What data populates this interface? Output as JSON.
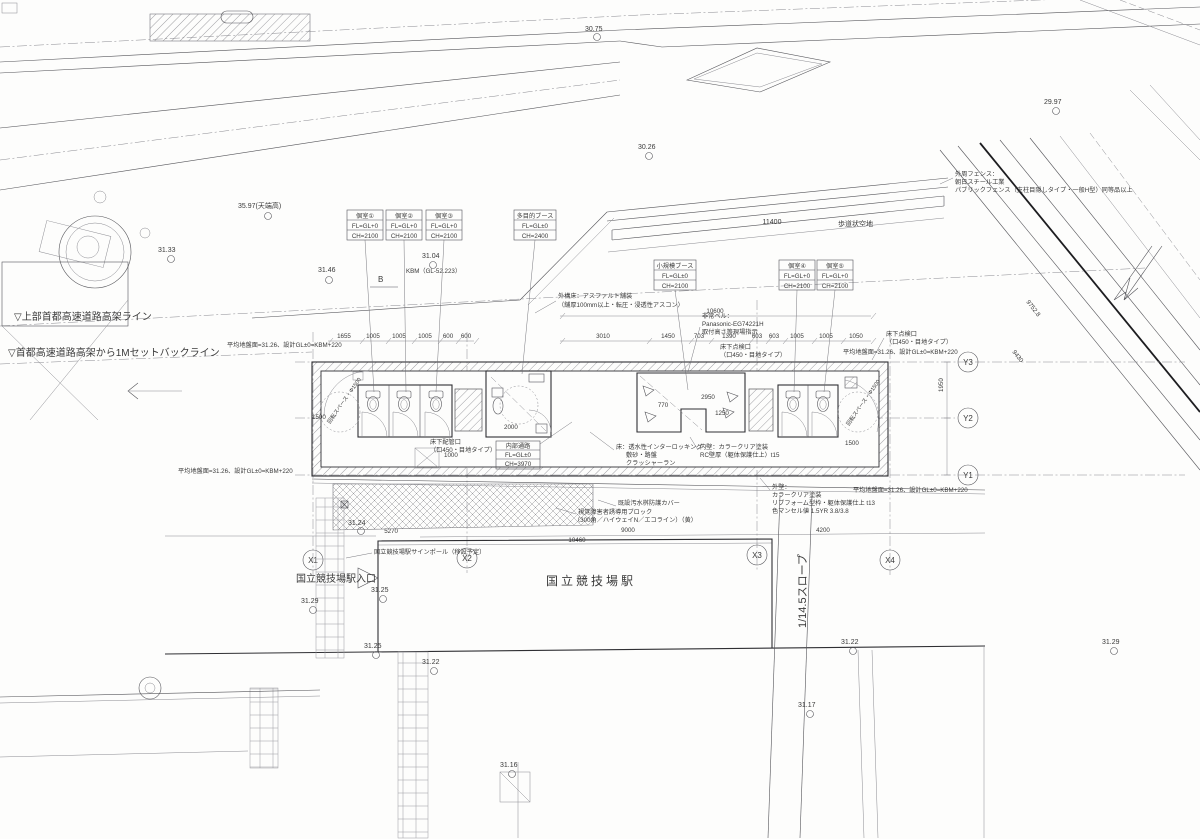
{
  "callouts": [
    {
      "title": "個室①",
      "fl": "FL=GL+0",
      "ch": "CH=2100"
    },
    {
      "title": "個室②",
      "fl": "FL=GL+0",
      "ch": "CH=2100"
    },
    {
      "title": "個室③",
      "fl": "FL=GL+0",
      "ch": "CH=2100"
    },
    {
      "title": "多目的ブース",
      "fl": "FL=GL±0",
      "ch": "CH=2400"
    },
    {
      "title": "小規模ブース",
      "fl": "FL=GL±0",
      "ch": "CH=2100"
    },
    {
      "title": "個室④",
      "fl": "FL=GL+0",
      "ch": "CH=2100"
    },
    {
      "title": "個室⑤",
      "fl": "FL=GL+0",
      "ch": "CH=2100"
    },
    {
      "title": "内部通路",
      "fl": "FL=GL±0",
      "ch": "CH=3970"
    }
  ],
  "grid": {
    "x": [
      "X1",
      "X2",
      "X3",
      "X4"
    ],
    "y": [
      "Y1",
      "Y2",
      "Y3"
    ]
  },
  "section_mark": "B",
  "places": {
    "station": "国立競技場駅",
    "entrance": "国立競技場駅入口",
    "slope": "1/14.5スロープ",
    "sign_pole": "国立競技場駅サインポール（移設予定）",
    "walkway": "歩道状空地"
  },
  "notes": {
    "setback_upper": "▽上部首都高速道路高架ライン",
    "setback_lower": "▽首都高速道路高架から1Mセットバックライン",
    "avg_ground": "平均地盤面=31.26、設計GL±0=KBM+220",
    "kbm": "KBM（GL-52.223）",
    "top_height": "35.97(天端高)",
    "pavement1": "外構床：アスファルト舗装",
    "pavement2": "（舗厚100mm以上・転圧・浸透性アスコン）",
    "bell1": "非常ベル：",
    "bell2": "Panasonic-EG74221H",
    "bell3": "取付高さ等現場指示",
    "hatch1": "床下点検口",
    "hatch2": "（口450・目地タイプ）",
    "pipe1": "床下配管口",
    "fence1": "外周フェンス：",
    "fence2": "朝日スチール工業",
    "fence3": "パブリックフェンス（支柱目隠しタイプ・一般H型）同等品以上",
    "floor1": "床：透水性インターロッキング",
    "floor2": "敷砂・路盤",
    "floor3": "クラッシャーラン",
    "wallin1": "内壁：カラークリア塗装",
    "wallin2": "RC壁厚（躯体保護仕上）t15",
    "wallout1": "外壁：",
    "wallout2": "カラークリア塗装",
    "wallout3": "リブフォーム型枠・躯体保護仕上 t13",
    "wallout4": "色マンセル値 1.5YR 3.8/3.8",
    "cover": "既設汚水桝防護カバー",
    "tactile1": "視覚障害者誘導用ブロック",
    "tactile2": "（300角／ハイウェイN／エコライン）（黄）",
    "rotate_space": "回転スペース・Φ1500"
  },
  "spots": {
    "s1": "30.75",
    "s2": "30.26",
    "s3": "29.97",
    "s4": "31.33",
    "s5": "31.46",
    "s6": "31.04",
    "s7": "31.24",
    "s8": "31.29",
    "s9": "31.25",
    "s10": "31.25",
    "s11": "31.22",
    "s12": "31.16",
    "s13": "31.17",
    "s14": "31.22",
    "s15": "31.29"
  },
  "dims": {
    "top_left": [
      "1655",
      "1005",
      "1005",
      "1005",
      "600",
      "600"
    ],
    "top_right": [
      "3010",
      "1450",
      "703",
      "1390",
      "603",
      "603",
      "1005",
      "1005",
      "1050"
    ],
    "total_top": "10600",
    "strip_total": "11400",
    "d5270": "5270",
    "d10460": "10460",
    "d9000": "9000",
    "d4200": "4200",
    "d1950": "1950",
    "interior": [
      "1500",
      "2000",
      "1000",
      "770",
      "2950",
      "1250",
      "1500"
    ],
    "diag": [
      "9752.8",
      "9430"
    ]
  }
}
